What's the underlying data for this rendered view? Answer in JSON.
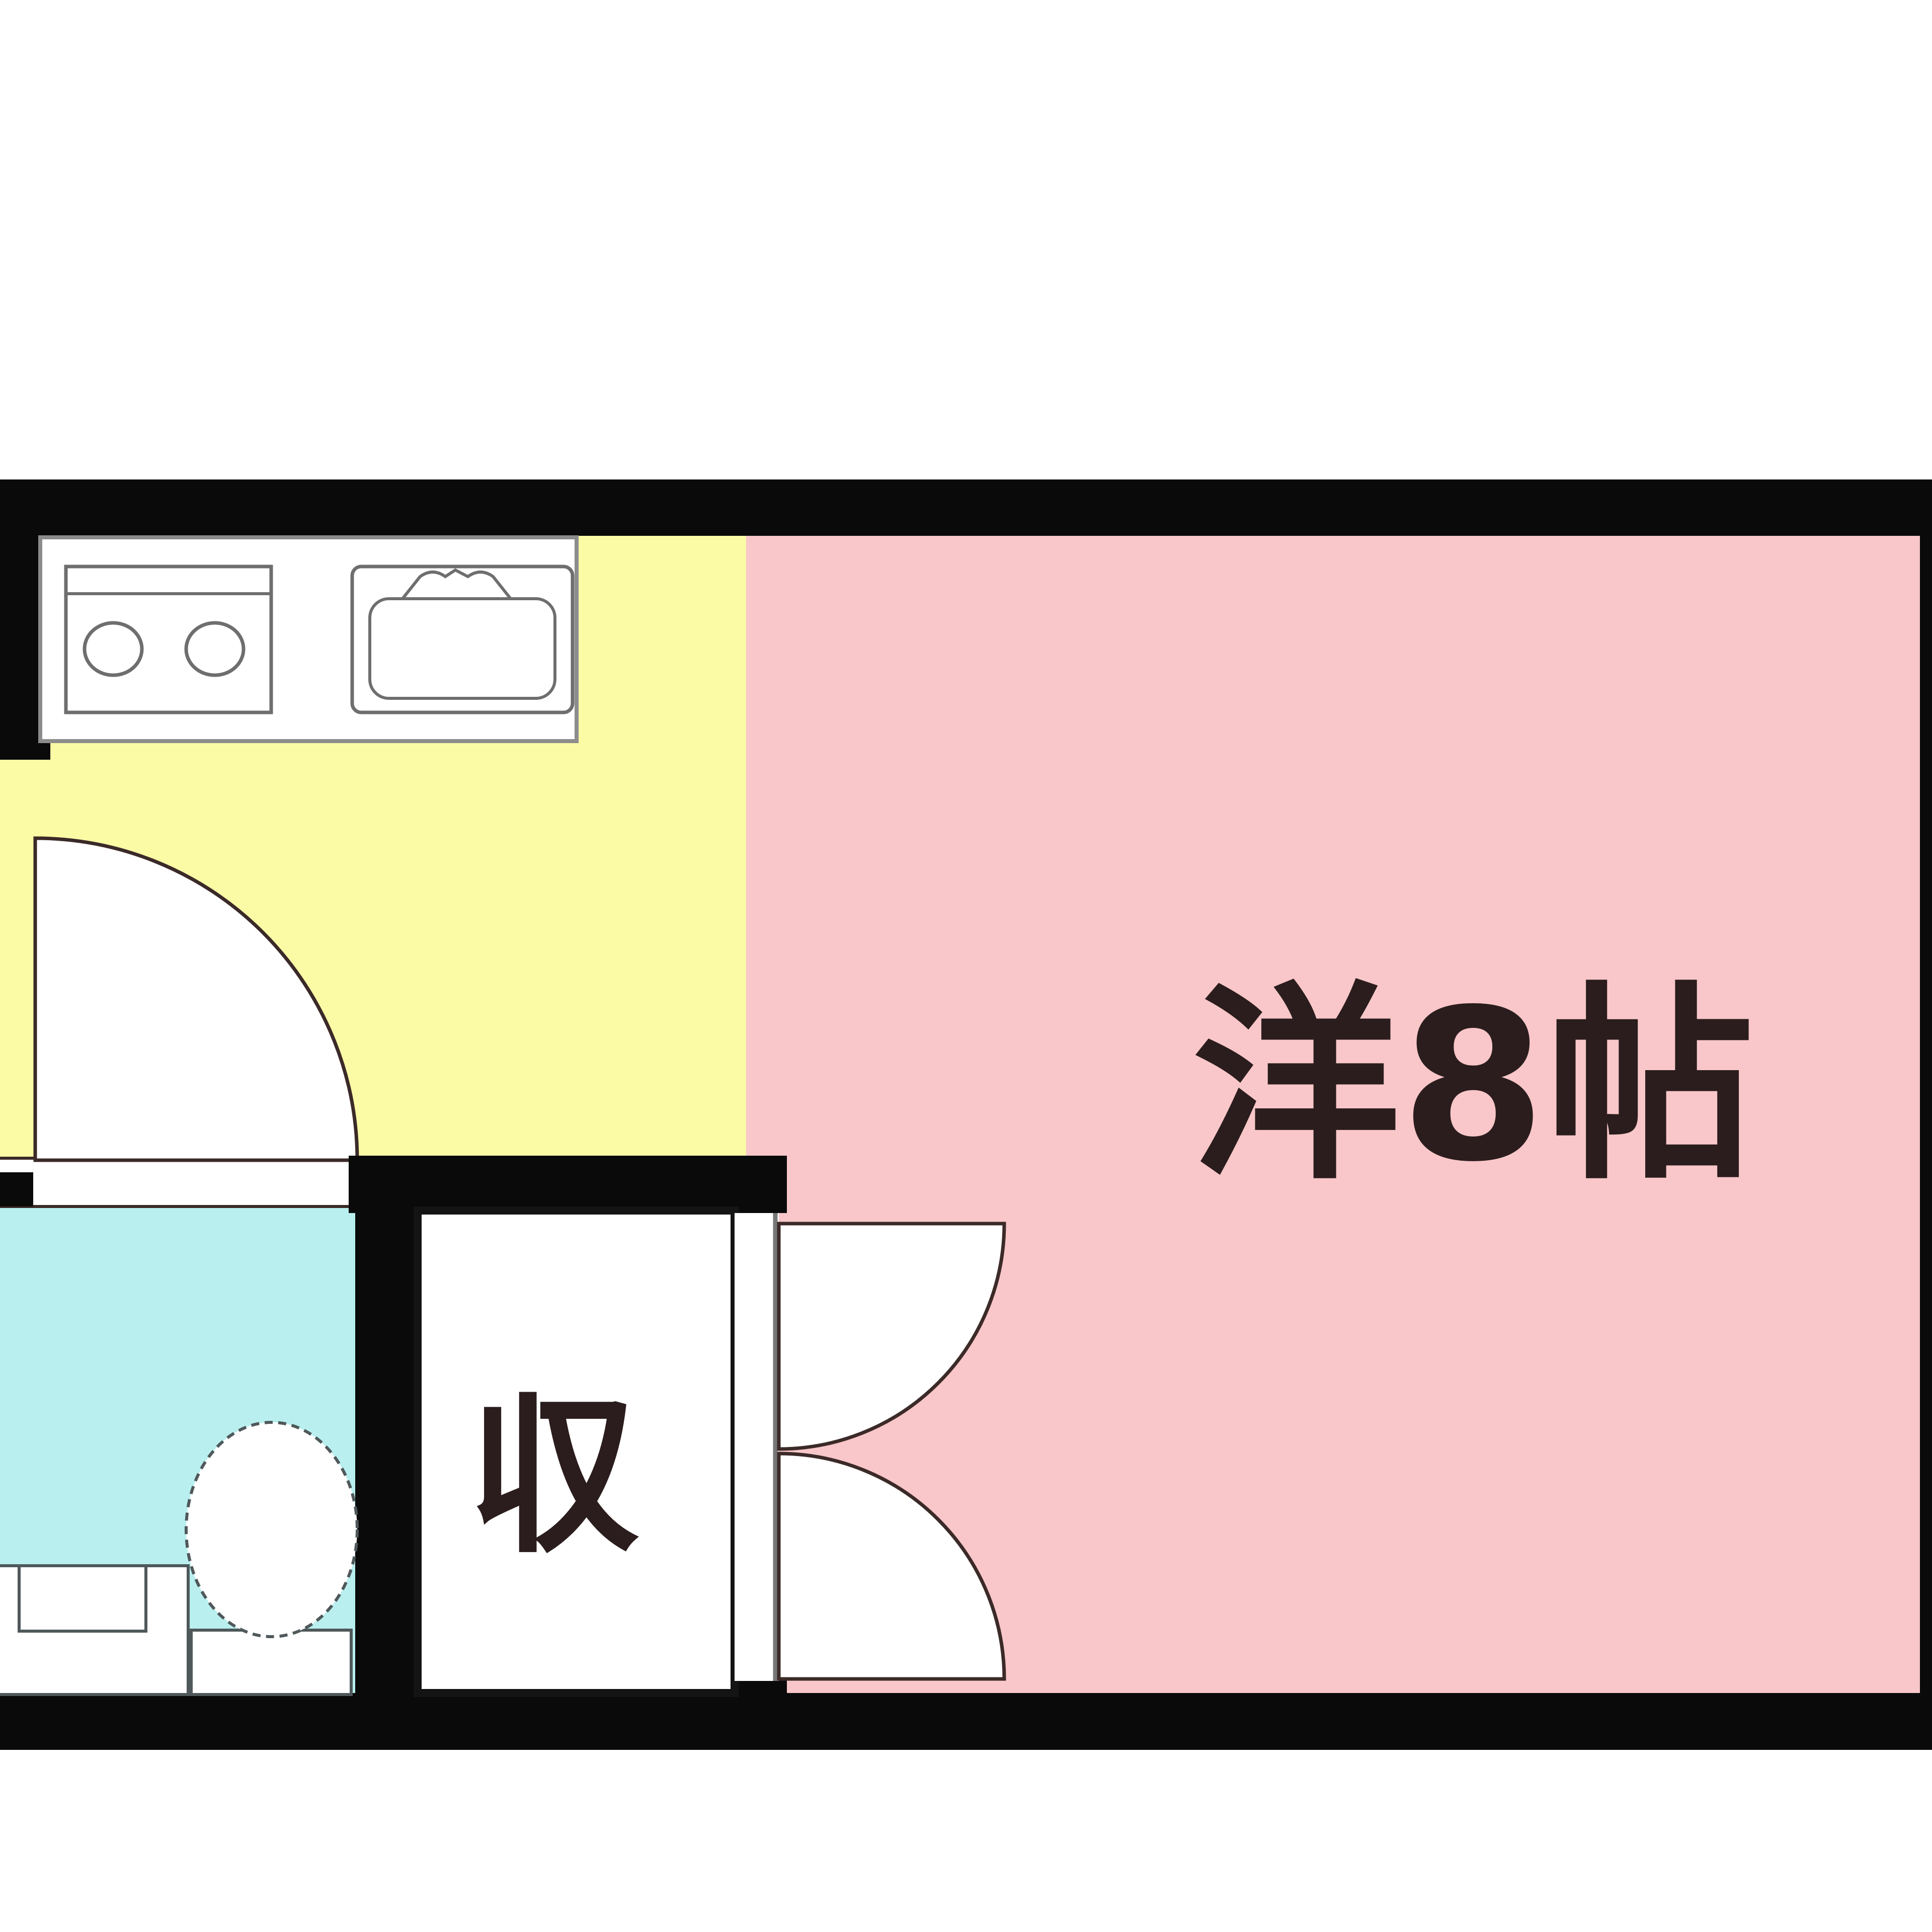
{
  "plan": {
    "type": "apartment-floor-plan",
    "rooms": {
      "western_room": {
        "label": "洋8帖"
      },
      "closet": {
        "label": "収"
      },
      "kitchen": {
        "label": ""
      },
      "bathroom": {
        "label": ""
      }
    },
    "colors": {
      "wall": "#0a0a0a",
      "kitchen_floor": "#fbfba6",
      "room_floor": "#f9c7c9",
      "bath_floor": "#b9efef",
      "door_fill": "#ffffff",
      "line": "#3b2a28",
      "fixture_stroke": "#6e6e6e",
      "bath_fixture_stroke": "#4f585a",
      "closet_border": "#141414",
      "label_color": "#2b1d1d",
      "background": "#ffffff"
    }
  }
}
